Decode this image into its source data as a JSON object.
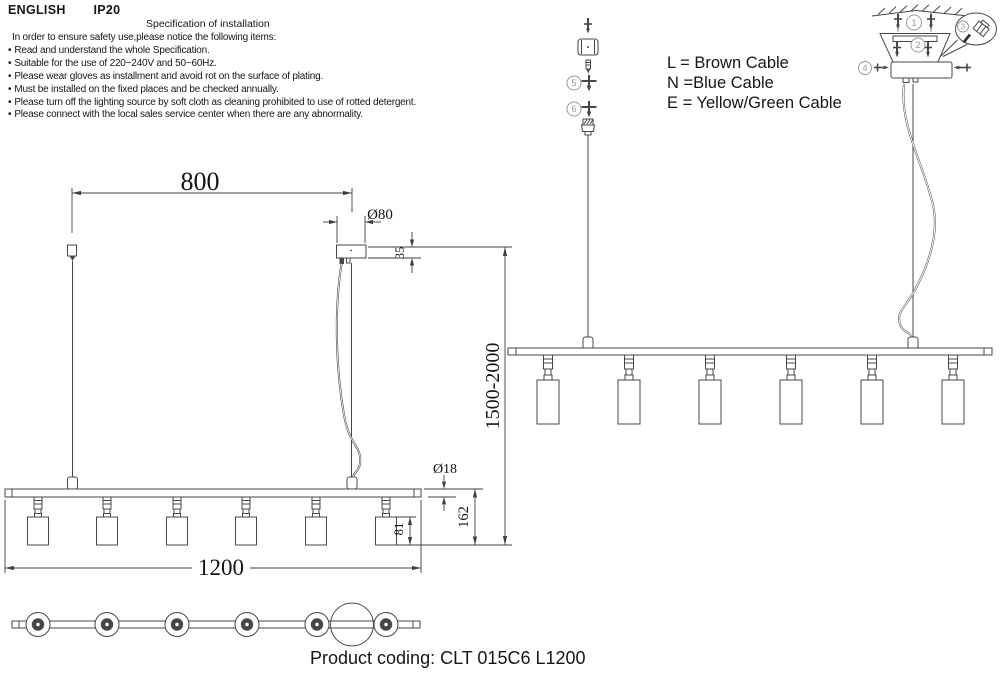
{
  "header": {
    "language": "ENGLISH",
    "ip": "IP20"
  },
  "spec": {
    "title": "Specification of installation",
    "intro": "In order to ensure safety use,please notice the following items:",
    "bullet": "•",
    "items": [
      "Read and understand the whole Specification.",
      "Suitable for the use of 220~240V and 50~60Hz.",
      "Please wear gloves as installment and avoid rot on the surface of plating.",
      "Must be installed on the fixed places and be checked annually.",
      "Please turn off the lighting source by soft cloth as cleaning prohibited to use of rotted detergent.",
      "Please connect with the local sales service center when there are any abnormality."
    ]
  },
  "legend": {
    "live": "L = Brown Cable",
    "neutral": "N =Blue Cable",
    "earth": "E = Yellow/Green Cable"
  },
  "dimensions": {
    "suspension_span": "800",
    "canopy_diameter": "Ø80",
    "canopy_height": "35",
    "suspension_height": "1500-2000",
    "tube_diameter": "Ø18",
    "drop_height": "162",
    "shade_height": "81",
    "fixture_length": "1200"
  },
  "callouts": {
    "c1": "1",
    "c2": "2",
    "c3": "3",
    "c4": "4",
    "c5": "5",
    "c6": "6"
  },
  "product_coding": "Product coding: CLT 015C6 L1200",
  "colors": {
    "line": "#474747",
    "dimension": "#3f3f3f",
    "text": "#161616",
    "callout": "#9a9a9a",
    "background": "#ffffff"
  }
}
